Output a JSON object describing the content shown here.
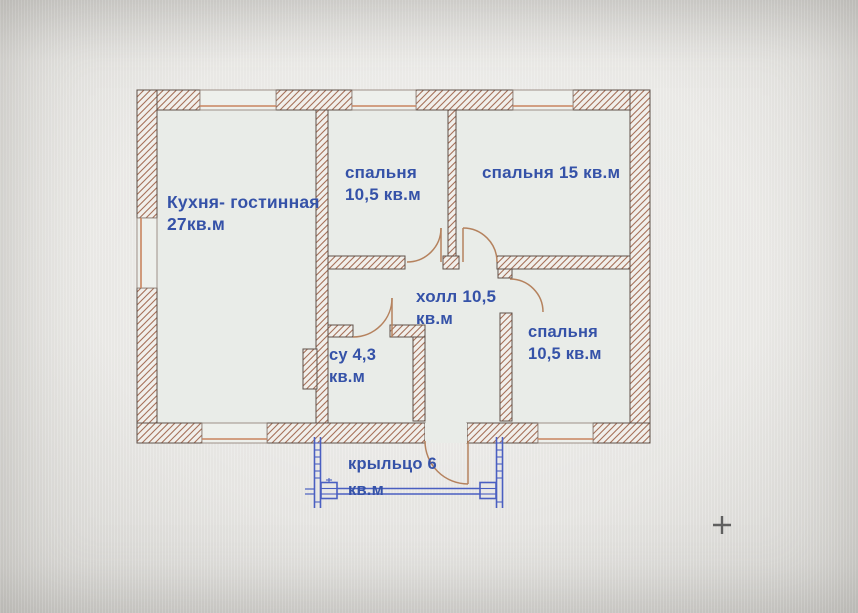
{
  "plan": {
    "type": "floor-plan-photo",
    "rooms": [
      {
        "id": "kitchen-living",
        "line1": "Кухня- гостинная",
        "line2": "27кв.м"
      },
      {
        "id": "bedroom-top-middle",
        "line1": "спальня",
        "line2": "10,5 кв.м"
      },
      {
        "id": "bedroom-top-right",
        "line1": "спальня 15 кв.м",
        "line2": ""
      },
      {
        "id": "hall",
        "line1": "холл 10,5",
        "line2": "кв.м"
      },
      {
        "id": "bathroom",
        "line1": "су 4,3",
        "line2": "кв.м"
      },
      {
        "id": "bedroom-bottom-right",
        "line1": "спальня",
        "line2": "10,5 кв.м"
      },
      {
        "id": "porch",
        "line1": "крыльцо 6",
        "line2": "кв.м"
      }
    ],
    "colors": {
      "label_blue": "#3552a8",
      "wall_outline": "#5f5149",
      "hatch_brown": "#a6715a",
      "window_accent_orange": "#c9845f",
      "door_arc_brown": "#b5825e",
      "porch_blue": "#4a5fc1",
      "cursor_gray": "#4a4a4a",
      "background": "#e9e8e5"
    },
    "watermark": "АН"
  }
}
